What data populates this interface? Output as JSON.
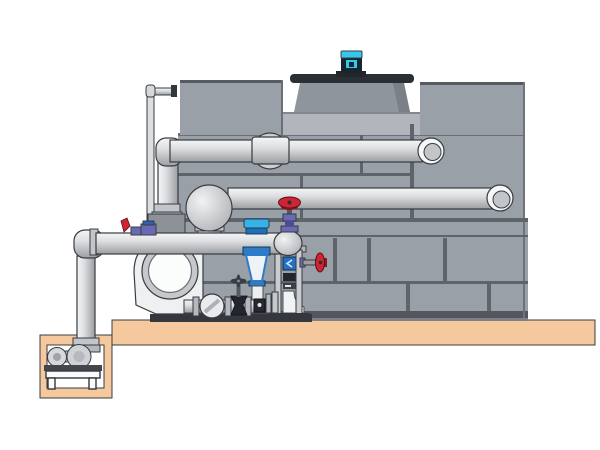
{
  "scene": {
    "description": "Side-elevation technical illustration of a packaged cooling tower with fan motor, external return piping, a centrifugal pump skid with valves, and a sump-pit pump on a concrete slab",
    "background": "#ffffff"
  },
  "palette": {
    "background": "#ffffff",
    "tank_panel": "#9aa0a8",
    "tank_panel_light": "#b2b6bc",
    "tank_seam": "#5f646b",
    "tank_edge_dark": "#565b61",
    "tank_dark_strip": "#53575d",
    "tank_mid_strip": "#7d8187",
    "cowl_gray": "#8f959d",
    "cowl_rim": "#2b2f34",
    "pipe_light": "#f4f5f6",
    "pipe_mid": "#d9dbdd",
    "pipe_dark": "#9b9ea2",
    "outline": "#383c41",
    "floor_tan": "#f5c89e",
    "equipment_white": "#eef0f1",
    "accent_cyan": "#35c8ea",
    "motor_dark": "#16262e",
    "valve_red": "#cf2434",
    "valve_red_dark": "#8e1822",
    "valve_purple": "#6a6ab4",
    "valve_blue": "#2e7cc8",
    "valve_blue_bright": "#38b2e4",
    "frame_metal": "#c9ccd0",
    "frame_dark": "#34383e",
    "flange_gray": "#b5b8bc"
  },
  "components": [
    "cooling-tower-casing",
    "fan-cowl",
    "fan-motor",
    "makeup-water-line",
    "upper-return-pipe",
    "mid-return-pipe",
    "suction-manifold",
    "butterfly-valve",
    "suction-diffuser",
    "red-handwheel-valve",
    "drain-valve",
    "pipe-support-frame",
    "centrifugal-pump",
    "check-valve",
    "gate-valve",
    "equipment-skid",
    "sump-riser-pipe",
    "sump-pit",
    "sump-pump",
    "pump-stand",
    "concrete-slab"
  ]
}
